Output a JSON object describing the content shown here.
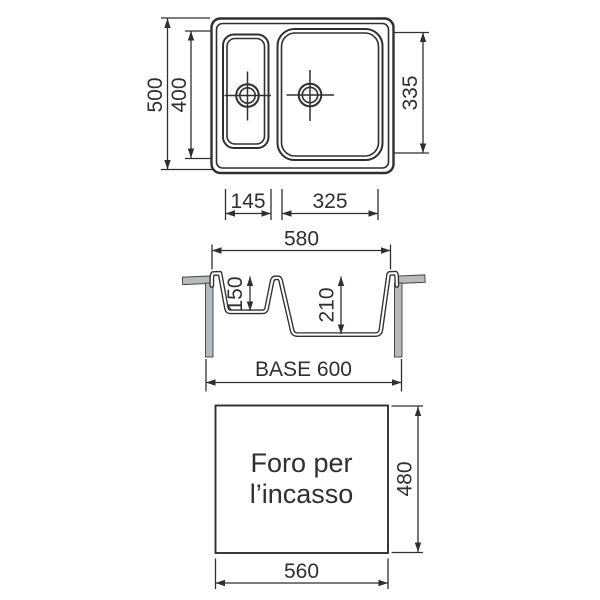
{
  "diagram": {
    "top_view": {
      "dim_height_outer": "500",
      "dim_height_inner": "400",
      "dim_bowl_height": "335",
      "dim_small_bowl_width": "145",
      "dim_large_bowl_width": "325"
    },
    "section_view": {
      "dim_width_top": "580",
      "dim_small_bowl_depth": "150",
      "dim_large_bowl_depth": "210",
      "dim_base": "BASE 600"
    },
    "cutout_view": {
      "label_line1": "Foro per",
      "label_line2": "l’incasso",
      "dim_height": "480",
      "dim_width": "560"
    },
    "colors": {
      "line": "#2f2f2f",
      "background": "#ffffff",
      "counter_gray": "#b7bbbd"
    }
  }
}
